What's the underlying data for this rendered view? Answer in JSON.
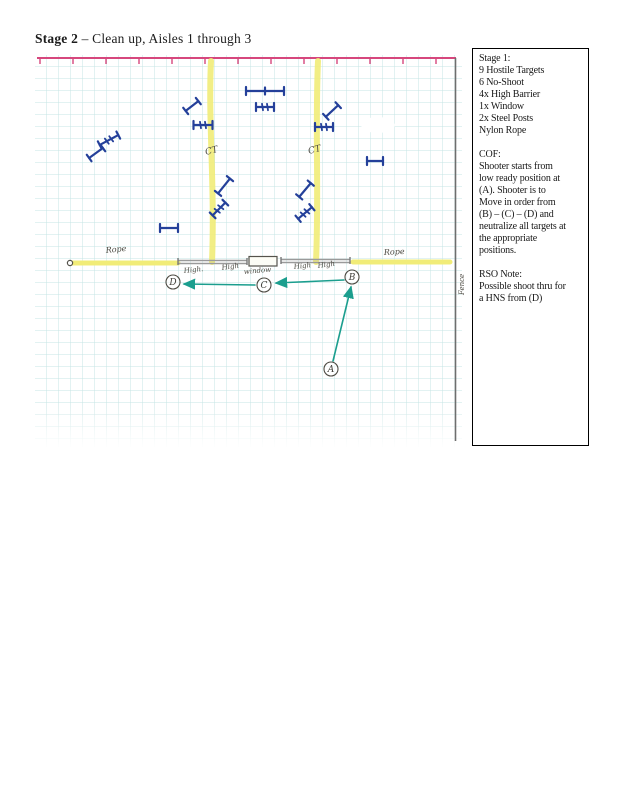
{
  "page": {
    "title_bold": "Stage 2",
    "title_rest": " – Clean up, Aisles 1 through 3"
  },
  "info_box": {
    "lines": [
      "Stage 1:",
      "9 Hostile Targets",
      "6 No-Shoot",
      "4x High Barrier",
      "1x Window",
      "2x Steel Posts",
      "Nylon Rope",
      "",
      "COF:",
      "Shooter starts from",
      "low ready position at",
      "(A). Shooter is to",
      "Move in order from",
      "(B) – (C) – (D) and",
      "neutralize all targets at",
      "the appropriate",
      "positions.",
      "",
      "RSO Note:",
      "Possible shoot thru for",
      "a HNS from (D)"
    ]
  },
  "diagram": {
    "colors": {
      "grid": "#c6e4e4",
      "range_line_pink": "#d6477d",
      "aisle_yellow": "#f1ec78",
      "target_blue": "#24409a",
      "arrow_teal": "#1b9e8e",
      "barrier_gray": "#9a9a9a",
      "ink": "#4c4a42"
    },
    "labels": [
      {
        "name": "aisle-left-label",
        "text": "CT",
        "x": 206,
        "y": 155,
        "rot": -15,
        "size": 9
      },
      {
        "name": "aisle-right-label",
        "text": "CT",
        "x": 309,
        "y": 154,
        "rot": -15,
        "size": 9
      },
      {
        "name": "rope-left-label",
        "text": "Rope",
        "x": 106,
        "y": 253,
        "rot": -6,
        "size": 8
      },
      {
        "name": "rope-right-label",
        "text": "Rope",
        "x": 384,
        "y": 255,
        "rot": -3,
        "size": 8
      },
      {
        "name": "barrier-left-label-1",
        "text": "High.",
        "x": 184,
        "y": 273,
        "rot": -6,
        "size": 7
      },
      {
        "name": "barrier-left-label-2",
        "text": "High",
        "x": 222,
        "y": 270,
        "rot": -8,
        "size": 7
      },
      {
        "name": "window-label",
        "text": "window",
        "x": 244,
        "y": 274,
        "rot": -5,
        "size": 7
      },
      {
        "name": "barrier-right-label-1",
        "text": "High",
        "x": 294,
        "y": 269,
        "rot": -6,
        "size": 7
      },
      {
        "name": "barrier-right-label-2",
        "text": "High",
        "x": 318,
        "y": 268,
        "rot": -8,
        "size": 7
      },
      {
        "name": "fence-label",
        "text": "Fence",
        "x": 464,
        "y": 295,
        "rot": -90,
        "size": 7
      }
    ],
    "positions": [
      {
        "label": "A",
        "x": 331,
        "y": 369
      },
      {
        "label": "B",
        "x": 352,
        "y": 277
      },
      {
        "label": "C",
        "x": 264,
        "y": 285
      },
      {
        "label": "D",
        "x": 173,
        "y": 282
      }
    ],
    "arrows": [
      {
        "name": "arrow-a-to-b",
        "from": [
          333,
          361
        ],
        "to": [
          351,
          287
        ]
      },
      {
        "name": "arrow-b-to-c",
        "from": [
          344,
          280
        ],
        "to": [
          276,
          283
        ]
      },
      {
        "name": "arrow-c-to-d",
        "from": [
          255,
          285
        ],
        "to": [
          184,
          284
        ]
      }
    ],
    "targets": [
      {
        "x": 109,
        "y": 140,
        "angle": -28,
        "len": 21,
        "type": "no-shoot"
      },
      {
        "x": 96,
        "y": 153,
        "angle": -36,
        "len": 17,
        "type": "hostile"
      },
      {
        "x": 169,
        "y": 228,
        "angle": 0,
        "len": 18,
        "type": "hostile"
      },
      {
        "x": 192,
        "y": 106,
        "angle": -38,
        "len": 16,
        "type": "hostile"
      },
      {
        "x": 203,
        "y": 125,
        "angle": 0,
        "len": 19,
        "type": "no-shoot"
      },
      {
        "x": 265,
        "y": 91,
        "angle": 0,
        "len": 38,
        "type": "hostile-center"
      },
      {
        "x": 265,
        "y": 107,
        "angle": 0,
        "len": 18,
        "type": "no-shoot"
      },
      {
        "x": 224,
        "y": 186,
        "angle": -51,
        "len": 19,
        "type": "hostile"
      },
      {
        "x": 219,
        "y": 209,
        "angle": -45,
        "len": 18,
        "type": "no-shoot"
      },
      {
        "x": 332,
        "y": 111,
        "angle": -43,
        "len": 17,
        "type": "hostile"
      },
      {
        "x": 324,
        "y": 127,
        "angle": 0,
        "len": 18,
        "type": "no-shoot"
      },
      {
        "x": 375,
        "y": 161,
        "angle": 0,
        "len": 16,
        "type": "hostile"
      },
      {
        "x": 305,
        "y": 190,
        "angle": -50,
        "len": 18,
        "type": "hostile"
      },
      {
        "x": 305,
        "y": 213,
        "angle": -40,
        "len": 18,
        "type": "no-shoot"
      }
    ]
  }
}
